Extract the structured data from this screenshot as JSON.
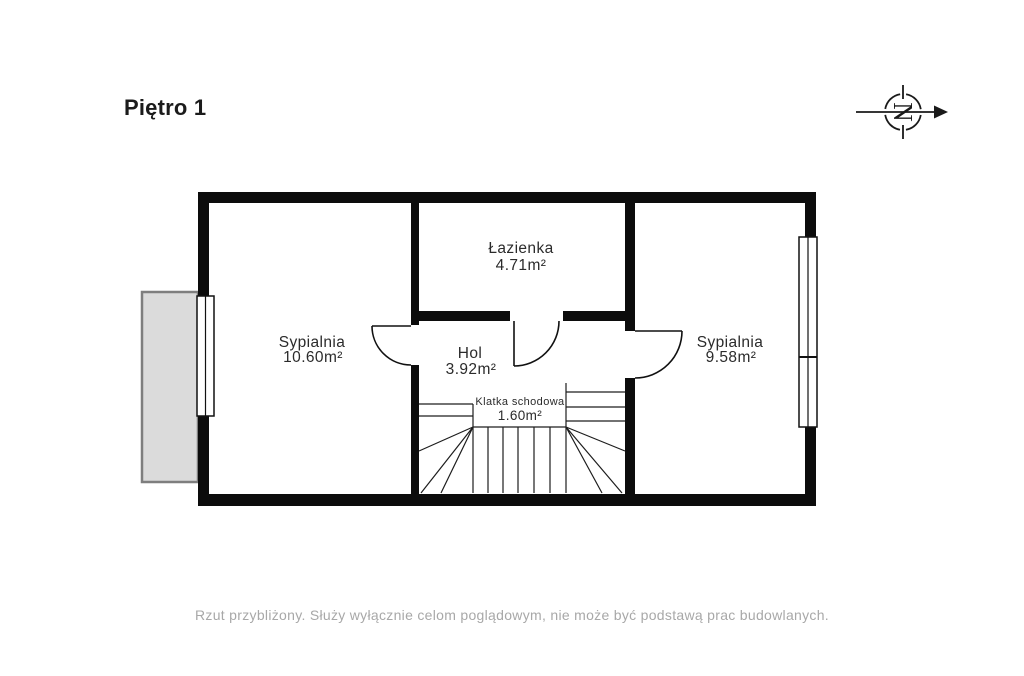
{
  "header": {
    "title": "Piętro 1"
  },
  "compass": {
    "letter": "N"
  },
  "rooms": [
    {
      "name": "Sypialnia",
      "area": "10.60m²"
    },
    {
      "name": "Łazienka",
      "area": "4.71m²"
    },
    {
      "name": "Hol",
      "area": "3.92m²"
    },
    {
      "name": "Klatka schodowa",
      "area": "1.60m²"
    },
    {
      "name": "Sypialnia",
      "area": "9.58m²"
    }
  ],
  "footer": {
    "disclaimer": "Rzut przybliżony. Służy wyłącznie celom poglądowym, nie może być podstawą prac budowlanych."
  },
  "colors": {
    "wall": "#0c0c0c",
    "balcony_fill": "#dbdbdb",
    "balcony_border": "#7e7e7e",
    "label": "#2b2b2b",
    "footer_text": "#a8a8a8"
  }
}
